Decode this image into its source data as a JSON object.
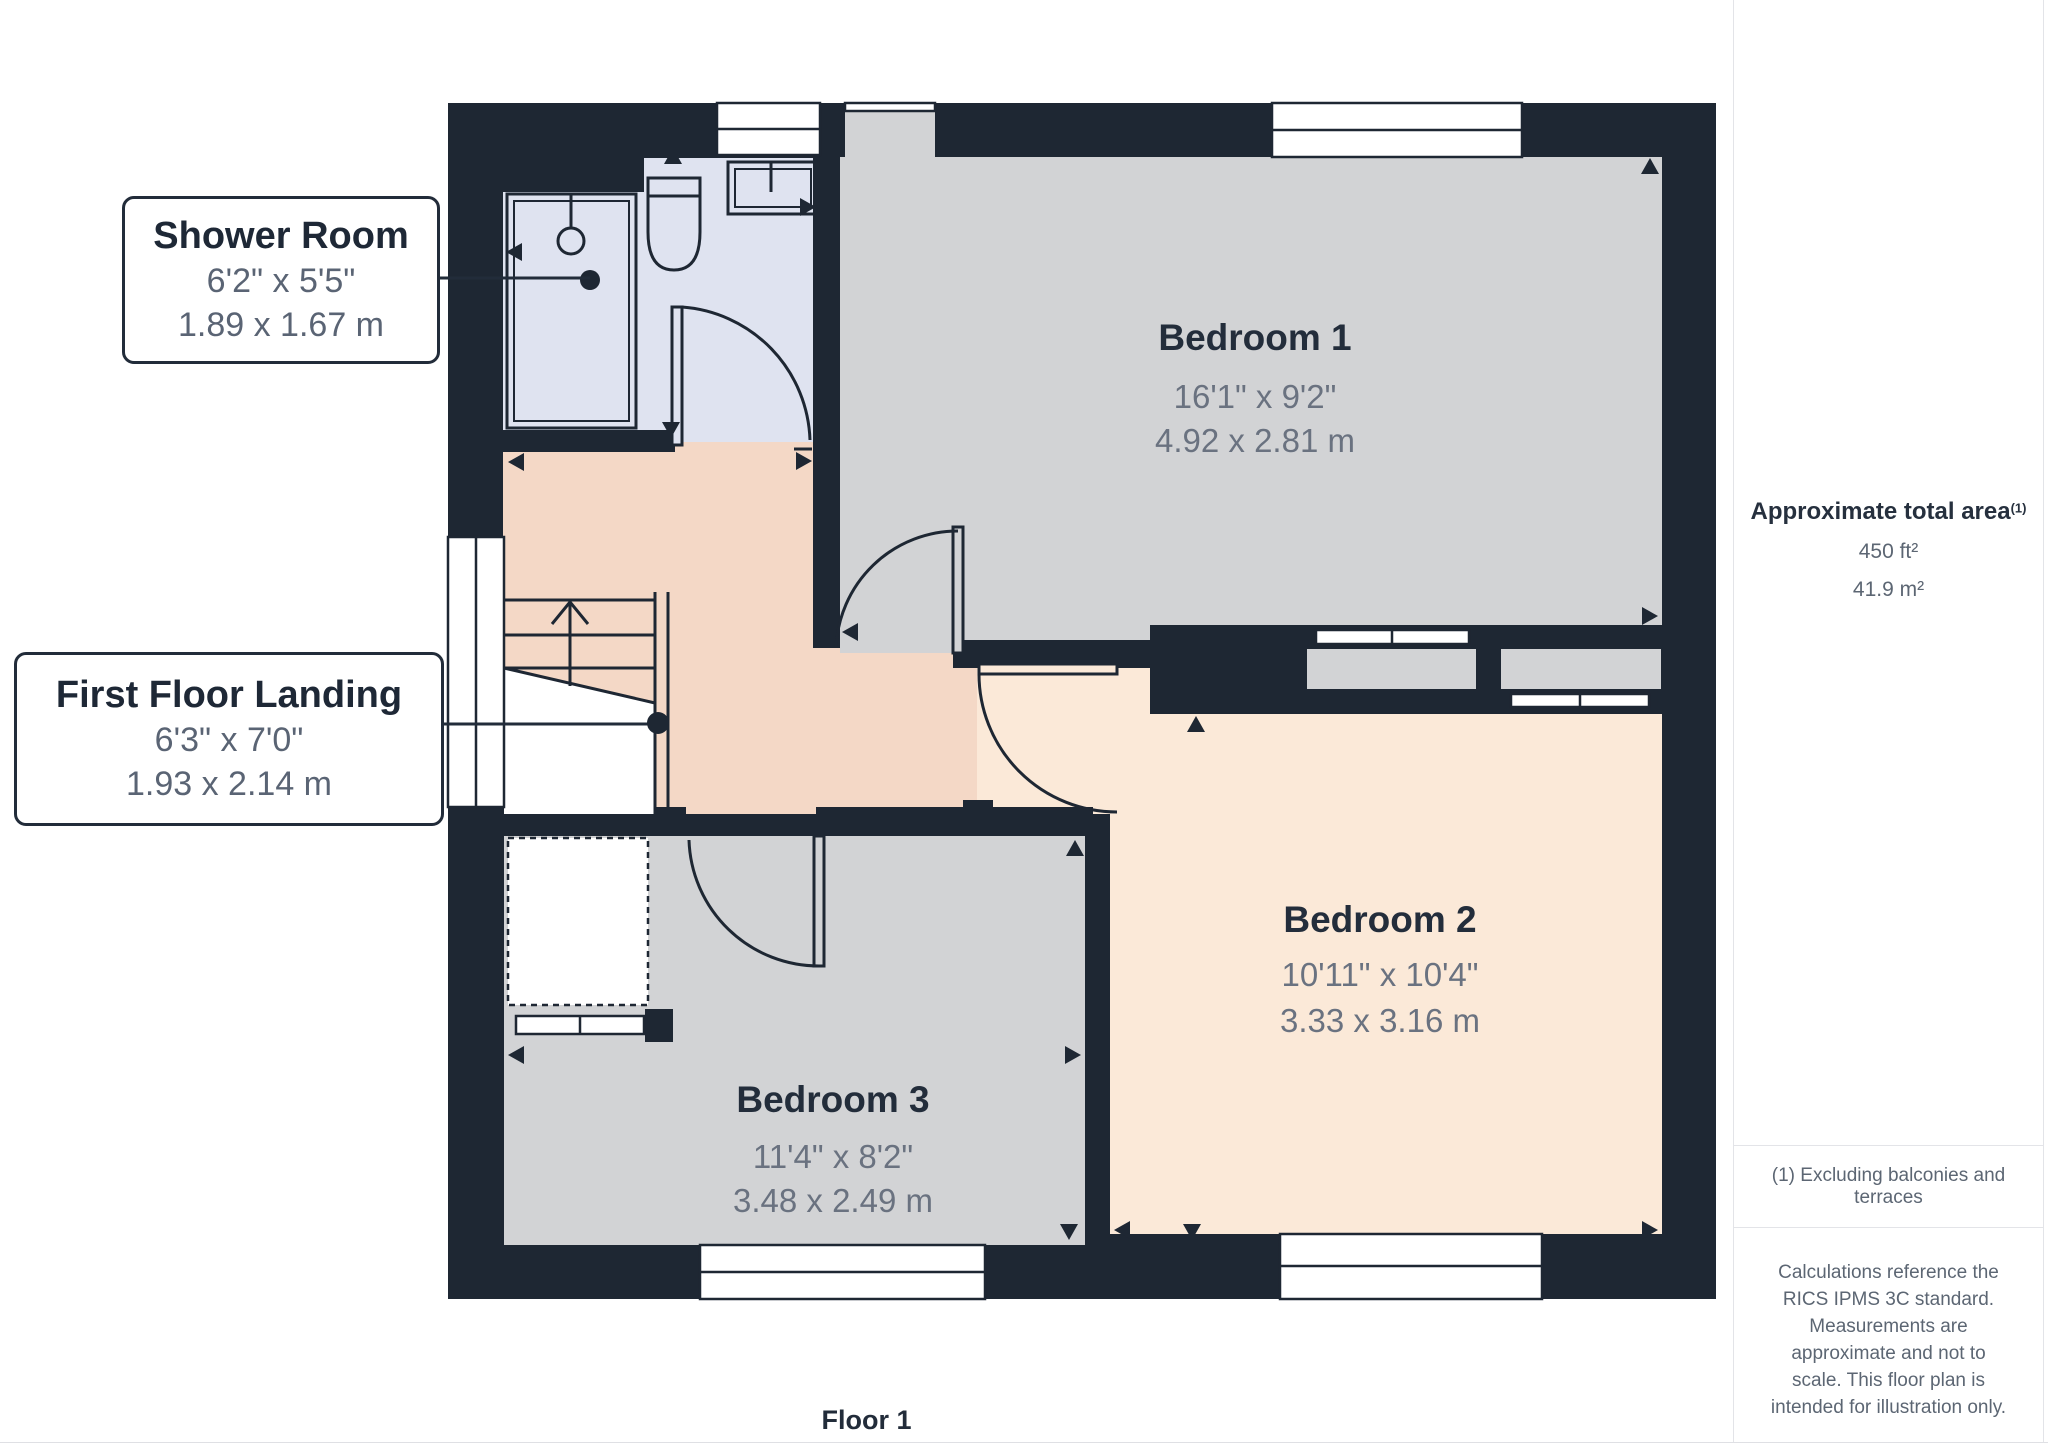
{
  "page": {
    "floor_label": "Floor 1"
  },
  "callouts": {
    "shower_room": {
      "title": "Shower Room",
      "imperial": "6'2\" x 5'5\"",
      "metric": "1.89 x 1.67 m"
    },
    "first_floor_landing": {
      "title": "First Floor Landing",
      "imperial": "6'3\" x 7'0\"",
      "metric": "1.93 x 2.14 m"
    }
  },
  "rooms": {
    "bedroom_1": {
      "name": "Bedroom 1",
      "imperial": "16'1\" x 9'2\"",
      "metric": "4.92 x 2.81 m"
    },
    "bedroom_2": {
      "name": "Bedroom 2",
      "imperial": "10'11\" x 10'4\"",
      "metric": "3.33 x 3.16 m"
    },
    "bedroom_3": {
      "name": "Bedroom 3",
      "imperial": "11'4\" x 8'2\"",
      "metric": "3.48 x 2.49 m"
    }
  },
  "sidebar": {
    "area_heading": "Approximate total area",
    "area_footnote_ref": "(1)",
    "area_imperial": "450 ft²",
    "area_metric": "41.9 m²",
    "footnote": "(1) Excluding balconies and terraces",
    "disclaimer": "Calculations reference the RICS IPMS 3C standard. Measurements are approximate and not to scale. This floor plan is intended for illustration only.",
    "brand_prefix": "GIRAFFE",
    "brand_suffix": "360"
  },
  "colors": {
    "wall": "#1e2733",
    "bedroom_floor": "#d2d3d5",
    "shower_floor": "#dfe3f0",
    "landing_floor": "#f4d8c6",
    "bedroom2_floor": "#fbe9d8",
    "label_title": "#232d3b",
    "label_dims": "#6a7280",
    "callout_border": "#222c3a"
  }
}
